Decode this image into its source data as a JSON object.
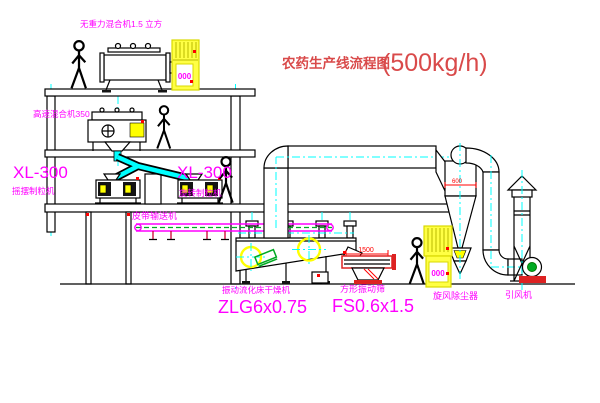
{
  "title": {
    "name_zh": "农药生产线流程图",
    "capacity": "(500kg/h)"
  },
  "colors": {
    "label_magenta": "#ff00ff",
    "title_red": "#d94a4a",
    "dimension_red": "#ff0000",
    "equipment_yellow": "#ffff00",
    "centerline_cyan": "#00ffff",
    "machine_green": "#00aa22",
    "base_red": "#dd2222",
    "line_black": "#000000"
  },
  "equipment": {
    "gravity_mixer": {
      "label": "无重力混合机1.5 立方"
    },
    "high_speed_mixer": {
      "label": "高速混合机350"
    },
    "granulator_left": {
      "model": "XL-300",
      "name": "摇摆制粒机"
    },
    "granulator_right": {
      "model": "XL-300",
      "name": "旋转制粒机"
    },
    "belt_conveyor": {
      "label": "皮带输送机"
    },
    "fluid_bed_dryer": {
      "name": "振动流化床干燥机",
      "model": "ZLG6x0.75"
    },
    "vibrating_sieve": {
      "name": "方形振动筛",
      "model": "FS0.6x1.5",
      "dim_width": "1500"
    },
    "cyclone": {
      "name": "旋风除尘器",
      "dim_diameter": "600"
    },
    "fan": {
      "name": "引风机"
    },
    "control_cabinet_1": {
      "display": "000"
    },
    "control_cabinet_2": {
      "display": "000"
    }
  }
}
